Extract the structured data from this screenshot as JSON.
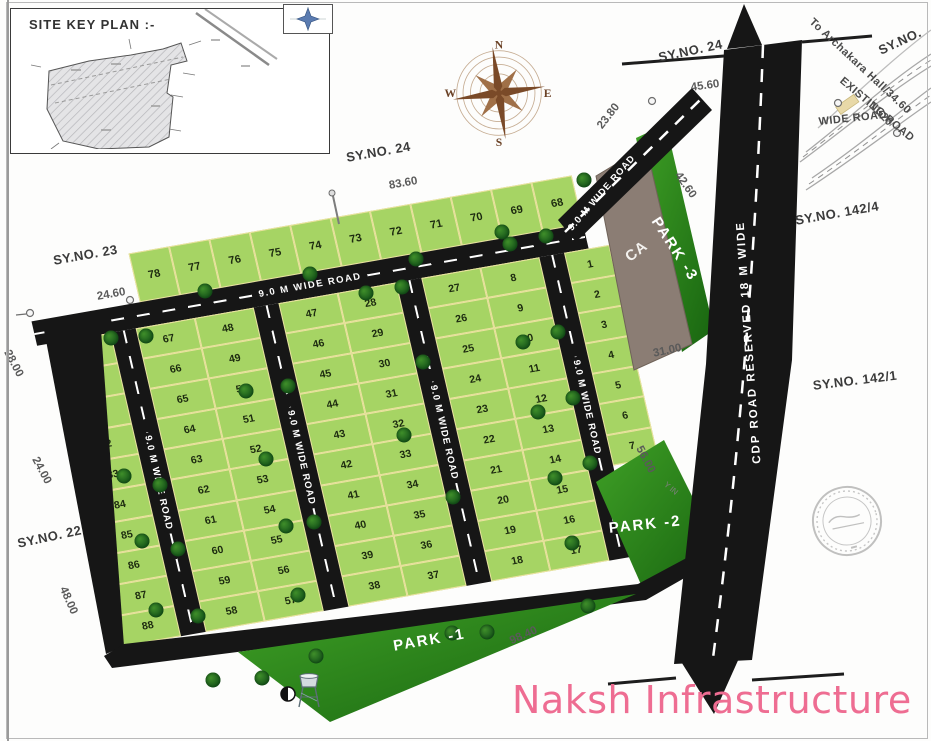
{
  "branding": {
    "name": "Naksh Infrastructure",
    "color": "#ee6d92"
  },
  "site_key_plan": {
    "title": "SITE KEY PLAN :-"
  },
  "compass": {
    "n": "N",
    "e": "E",
    "s": "S",
    "w": "W"
  },
  "roads": {
    "internal_label": "9.0 M WIDE ROAD",
    "cdp_label": "CDP ROAD RESERVED 18 M WIDE",
    "road_color": "#161616",
    "dash_color": "#ffffff"
  },
  "colors": {
    "plot_green": "#a6d464",
    "plot_border": "#ece2a0",
    "park_green": "#2e8c1d",
    "ca_brown": "#8b7d74",
    "brand_pink": "#ee6d92"
  },
  "estate": {
    "road_label": "9.0 M WIDE ROAD",
    "top_row": [
      "78",
      "77",
      "76",
      "75",
      "74",
      "73",
      "72",
      "71",
      "70",
      "69",
      "68"
    ],
    "columns": [
      {
        "type": "plots",
        "plots": [
          "79",
          "80",
          "81",
          "82",
          "83",
          "84",
          "85",
          "86",
          "87",
          "88"
        ]
      },
      {
        "type": "road"
      },
      {
        "type": "plots",
        "plots": [
          "67",
          "66",
          "65",
          "64",
          "63",
          "62",
          "61",
          "60",
          "59",
          "58"
        ]
      },
      {
        "type": "plots",
        "plots": [
          "48",
          "49",
          "50",
          "51",
          "52",
          "53",
          "54",
          "55",
          "56",
          "57"
        ]
      },
      {
        "type": "road"
      },
      {
        "type": "plots",
        "plots": [
          "47",
          "46",
          "45",
          "44",
          "43",
          "42",
          "41",
          "40",
          "39",
          "38"
        ]
      },
      {
        "type": "plots",
        "plots": [
          "28",
          "29",
          "30",
          "31",
          "32",
          "33",
          "34",
          "35",
          "36",
          "37"
        ]
      },
      {
        "type": "road"
      },
      {
        "type": "plots",
        "plots": [
          "27",
          "26",
          "25",
          "24",
          "23",
          "22",
          "21",
          "20",
          "19",
          "18"
        ]
      },
      {
        "type": "plots",
        "plots": [
          "8",
          "9",
          "10",
          "11",
          "12",
          "13",
          "14",
          "15",
          "16",
          "17"
        ]
      },
      {
        "type": "road"
      },
      {
        "type": "plots",
        "plots": [
          "1",
          "2",
          "3",
          "4",
          "5",
          "6",
          "7"
        ],
        "short": true
      }
    ]
  },
  "area_labels": [
    {
      "t": "PARK -1",
      "x": 392,
      "y": 638,
      "r": -10,
      "cls": "park"
    },
    {
      "t": "PARK -2",
      "x": 608,
      "y": 520,
      "r": -6,
      "cls": "park"
    },
    {
      "t": "PARK -3",
      "x": 662,
      "y": 214,
      "r": 57,
      "cls": "park"
    },
    {
      "t": "CA",
      "x": 622,
      "y": 252,
      "r": -38,
      "cls": "ca"
    }
  ],
  "annotations": [
    {
      "t": "SY.NO. 24",
      "x": 345,
      "y": 150,
      "r": -10,
      "cls": "survey"
    },
    {
      "t": "SY.NO. 23",
      "x": 52,
      "y": 253,
      "r": -10,
      "cls": "survey"
    },
    {
      "t": "SY.NO. 22",
      "x": 16,
      "y": 536,
      "r": -12,
      "cls": "survey"
    },
    {
      "t": "SY.NO. 24",
      "x": 657,
      "y": 50,
      "r": -12,
      "cls": "survey"
    },
    {
      "t": "SY.NO. 142/4",
      "x": 794,
      "y": 213,
      "r": -10,
      "cls": "survey"
    },
    {
      "t": "SY.NO. 142/1",
      "x": 812,
      "y": 378,
      "r": -7,
      "cls": "survey"
    },
    {
      "t": "SY.NO.",
      "x": 876,
      "y": 44,
      "r": -25,
      "cls": "survey"
    },
    {
      "t": "83.60",
      "x": 388,
      "y": 180,
      "r": -10,
      "cls": "dim"
    },
    {
      "t": "24.60",
      "x": 96,
      "y": 291,
      "r": -10,
      "cls": "dim"
    },
    {
      "t": "28.00",
      "x": 12,
      "y": 348,
      "r": 62,
      "cls": "dim"
    },
    {
      "t": "24.00",
      "x": 40,
      "y": 455,
      "r": 62,
      "cls": "dim"
    },
    {
      "t": "48.00",
      "x": 68,
      "y": 585,
      "r": 66,
      "cls": "dim"
    },
    {
      "t": "45.60",
      "x": 690,
      "y": 82,
      "r": -8,
      "cls": "dim"
    },
    {
      "t": "23.80",
      "x": 595,
      "y": 124,
      "r": -52,
      "cls": "dim"
    },
    {
      "t": "42.60",
      "x": 682,
      "y": 170,
      "r": 55,
      "cls": "dim"
    },
    {
      "t": "31.00",
      "x": 652,
      "y": 348,
      "r": -12,
      "cls": "dim"
    },
    {
      "t": "56.00",
      "x": 644,
      "y": 444,
      "r": 62,
      "cls": "dim"
    },
    {
      "t": "98.40",
      "x": 508,
      "y": 636,
      "r": -24,
      "cls": "dim"
    },
    {
      "t": "11.20",
      "x": 875,
      "y": 100,
      "r": 45,
      "cls": "dim"
    },
    {
      "t": "WIDE ROAD",
      "x": 818,
      "y": 116,
      "r": -6,
      "cls": "roadtext"
    },
    {
      "t": "EXISTING ROAD",
      "x": 845,
      "y": 75,
      "r": 40,
      "cls": "roadtext"
    },
    {
      "t": "To Archakara Hall/34.60",
      "x": 815,
      "y": 16,
      "r": 43,
      "cls": "roadtext"
    },
    {
      "t": "Y IN",
      "x": 668,
      "y": 480,
      "r": 40,
      "cls": "tiny"
    }
  ],
  "trees": [
    [
      205,
      291
    ],
    [
      310,
      274
    ],
    [
      416,
      259
    ],
    [
      510,
      244
    ],
    [
      584,
      180
    ],
    [
      546,
      236
    ],
    [
      502,
      232
    ],
    [
      111,
      338
    ],
    [
      146,
      336
    ],
    [
      124,
      476
    ],
    [
      160,
      485
    ],
    [
      142,
      541
    ],
    [
      178,
      549
    ],
    [
      156,
      610
    ],
    [
      198,
      616
    ],
    [
      213,
      680
    ],
    [
      262,
      678
    ],
    [
      246,
      391
    ],
    [
      288,
      386
    ],
    [
      266,
      459
    ],
    [
      286,
      526
    ],
    [
      314,
      522
    ],
    [
      298,
      595
    ],
    [
      316,
      656
    ],
    [
      366,
      293
    ],
    [
      402,
      287
    ],
    [
      423,
      362
    ],
    [
      404,
      435
    ],
    [
      453,
      497
    ],
    [
      452,
      633
    ],
    [
      487,
      632
    ],
    [
      523,
      342
    ],
    [
      558,
      332
    ],
    [
      538,
      412
    ],
    [
      573,
      398
    ],
    [
      555,
      478
    ],
    [
      590,
      463
    ],
    [
      572,
      543
    ],
    [
      588,
      606
    ]
  ],
  "markers": [
    [
      30,
      313
    ],
    [
      130,
      300
    ],
    [
      652,
      101
    ],
    [
      838,
      103
    ],
    [
      897,
      133
    ]
  ]
}
